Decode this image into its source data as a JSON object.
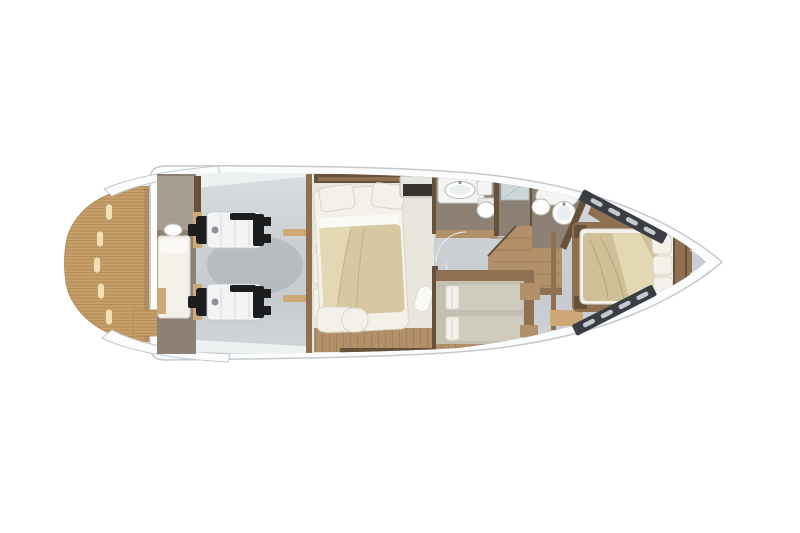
{
  "page": {
    "background": "#ffffff"
  },
  "figure": {
    "kind": "yacht-lower-deck-floorplan",
    "orientation": "bow-right"
  },
  "palette": {
    "hull-fill": "#fbfcfd",
    "hull-stroke": "#c5c9cd",
    "deck-1": "#dadde0",
    "deck-2": "#cdd1d4",
    "deck-3": "#c7cbcf",
    "deck-4": "#d3d6d9",
    "teak": "#c79f68",
    "teak-stripe": "#b08a53",
    "teak-slot": "#f2e0b4",
    "wood-dark": "#66513b",
    "wood-mid": "#8f7050",
    "wood-light": "#b2906a",
    "wood-line": "#9c7d58",
    "sandy": "#cfa878",
    "taupe": "#8c8174",
    "taupe-light": "#a79e90",
    "cream": "#e9e6dc",
    "linen": "#f3f1ea",
    "linen-stroke": "#d9d5c8",
    "sheet": "#faf9f5",
    "bed-beige": "#d6c8a0",
    "bed-beige-light": "#e3d7b4",
    "bed-gray": "#cfccbe",
    "guest-floor": "#c4c1b3",
    "vip-tan": "#cfc098",
    "engine-white": "#f2f3f5",
    "engine-dark": "#1c1d1f",
    "engine-mid": "#8e9296",
    "window-dark": "#3a3e44",
    "window-slot": "#c6cad0",
    "porcelain": "#fdfdfd",
    "porcelain-inner": "#ecefef",
    "porcelain-stroke": "#b9b9b4",
    "glass": "#ccd7da",
    "white-band": "#eef1f2",
    "seam": "#e9ecee",
    "shadow": "rgba(70,76,82,0.14)"
  }
}
